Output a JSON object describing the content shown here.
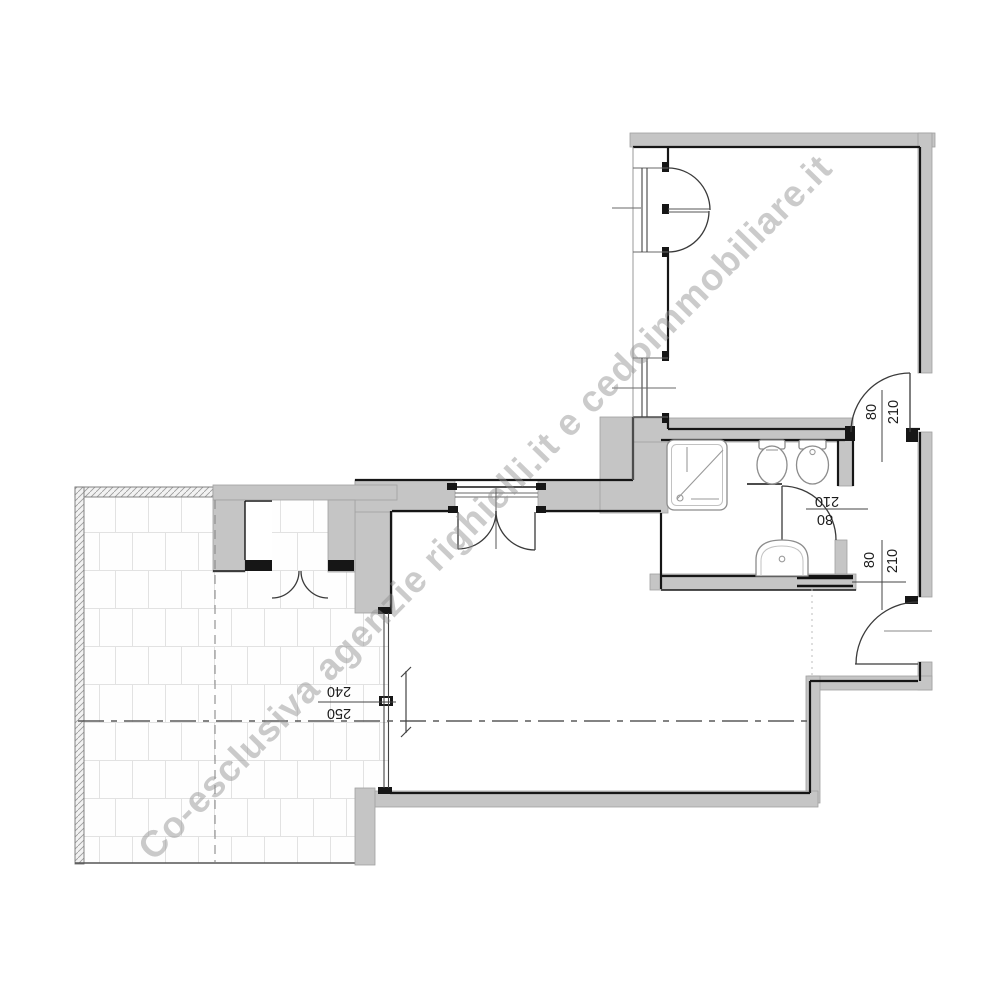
{
  "watermark": {
    "text": "Co-esclusiva agenzie righielli.it e cedoimmobiliare.it"
  },
  "dimensions": {
    "bedroom_door": {
      "width": "80",
      "height": "210"
    },
    "bathroom_door": {
      "width": "80",
      "height": "210"
    },
    "entrance_door": {
      "width": "80",
      "height": "210"
    },
    "living_window": {
      "height": "240",
      "width": "250"
    }
  },
  "colors": {
    "wall_fill": "#c5c5c5",
    "outline": "#161616",
    "watermark": "#909090",
    "tile_line": "#e2e2e2"
  }
}
